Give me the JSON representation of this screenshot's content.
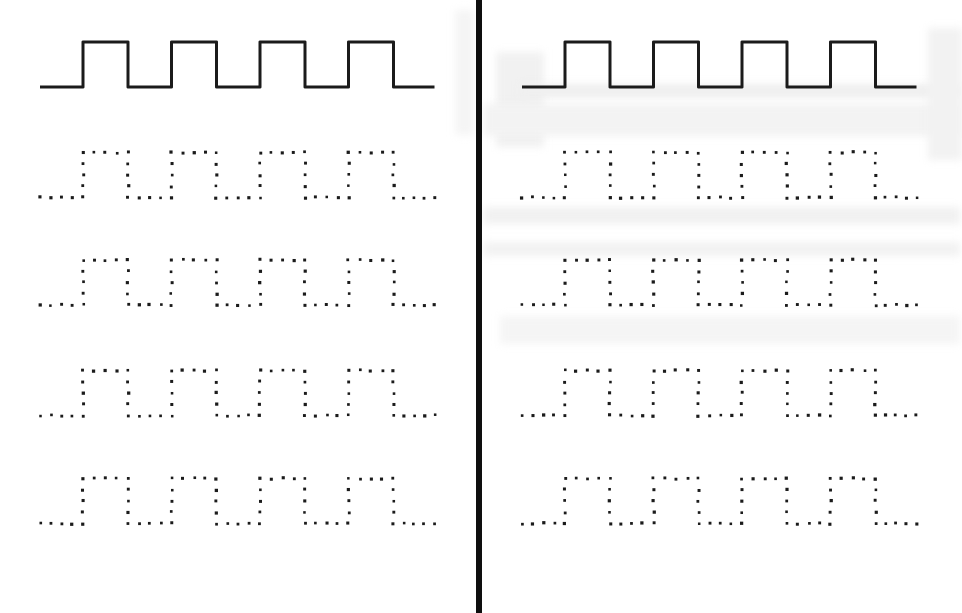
{
  "document": {
    "kind": "square-wave tracing worksheet scan",
    "background_color": "#ffffff",
    "ink_color": "#1b1b1b",
    "divider_color": "#0e0e0e"
  },
  "divider": {
    "x": 476,
    "width": 5.5
  },
  "pattern": {
    "type": "square-wave",
    "pulses": 4,
    "lead_in": 43,
    "pulse_width": 45,
    "gap_width": 43.5,
    "tail": 41,
    "amplitude": 45,
    "solid_stroke_width": 3,
    "dot_step": 11,
    "dot_size": 2.9
  },
  "panels": [
    {
      "name": "left",
      "x0": 40,
      "rows": [
        {
          "style": "solid",
          "baseline_y": 87
        },
        {
          "style": "dotted",
          "baseline_y": 197.5
        },
        {
          "style": "dotted",
          "baseline_y": 305
        },
        {
          "style": "dotted",
          "baseline_y": 415.5
        },
        {
          "style": "dotted",
          "baseline_y": 523.5
        }
      ]
    },
    {
      "name": "right",
      "x0": 522,
      "rows": [
        {
          "style": "solid",
          "baseline_y": 87
        },
        {
          "style": "dotted",
          "baseline_y": 197.5
        },
        {
          "style": "dotted",
          "baseline_y": 305
        },
        {
          "style": "dotted",
          "baseline_y": 415.5
        },
        {
          "style": "dotted",
          "baseline_y": 523.5
        }
      ]
    }
  ],
  "scan_artifacts": [
    {
      "x": 496,
      "y": 52,
      "w": 48,
      "h": 95,
      "color": "#f1f1f1"
    },
    {
      "x": 520,
      "y": 84,
      "w": 440,
      "h": 14,
      "color": "#efefef"
    },
    {
      "x": 484,
      "y": 104,
      "w": 476,
      "h": 32,
      "color": "#f3f3f3"
    },
    {
      "x": 484,
      "y": 207,
      "w": 476,
      "h": 17,
      "color": "#f1f1f1"
    },
    {
      "x": 484,
      "y": 242,
      "w": 476,
      "h": 14,
      "color": "#f2f2f2"
    },
    {
      "x": 500,
      "y": 316,
      "w": 460,
      "h": 28,
      "color": "#f5f5f5"
    },
    {
      "x": 928,
      "y": 28,
      "w": 34,
      "h": 132,
      "color": "#f2f2f2"
    },
    {
      "x": 455,
      "y": 10,
      "w": 19,
      "h": 125,
      "color": "#f5f5f5"
    }
  ]
}
